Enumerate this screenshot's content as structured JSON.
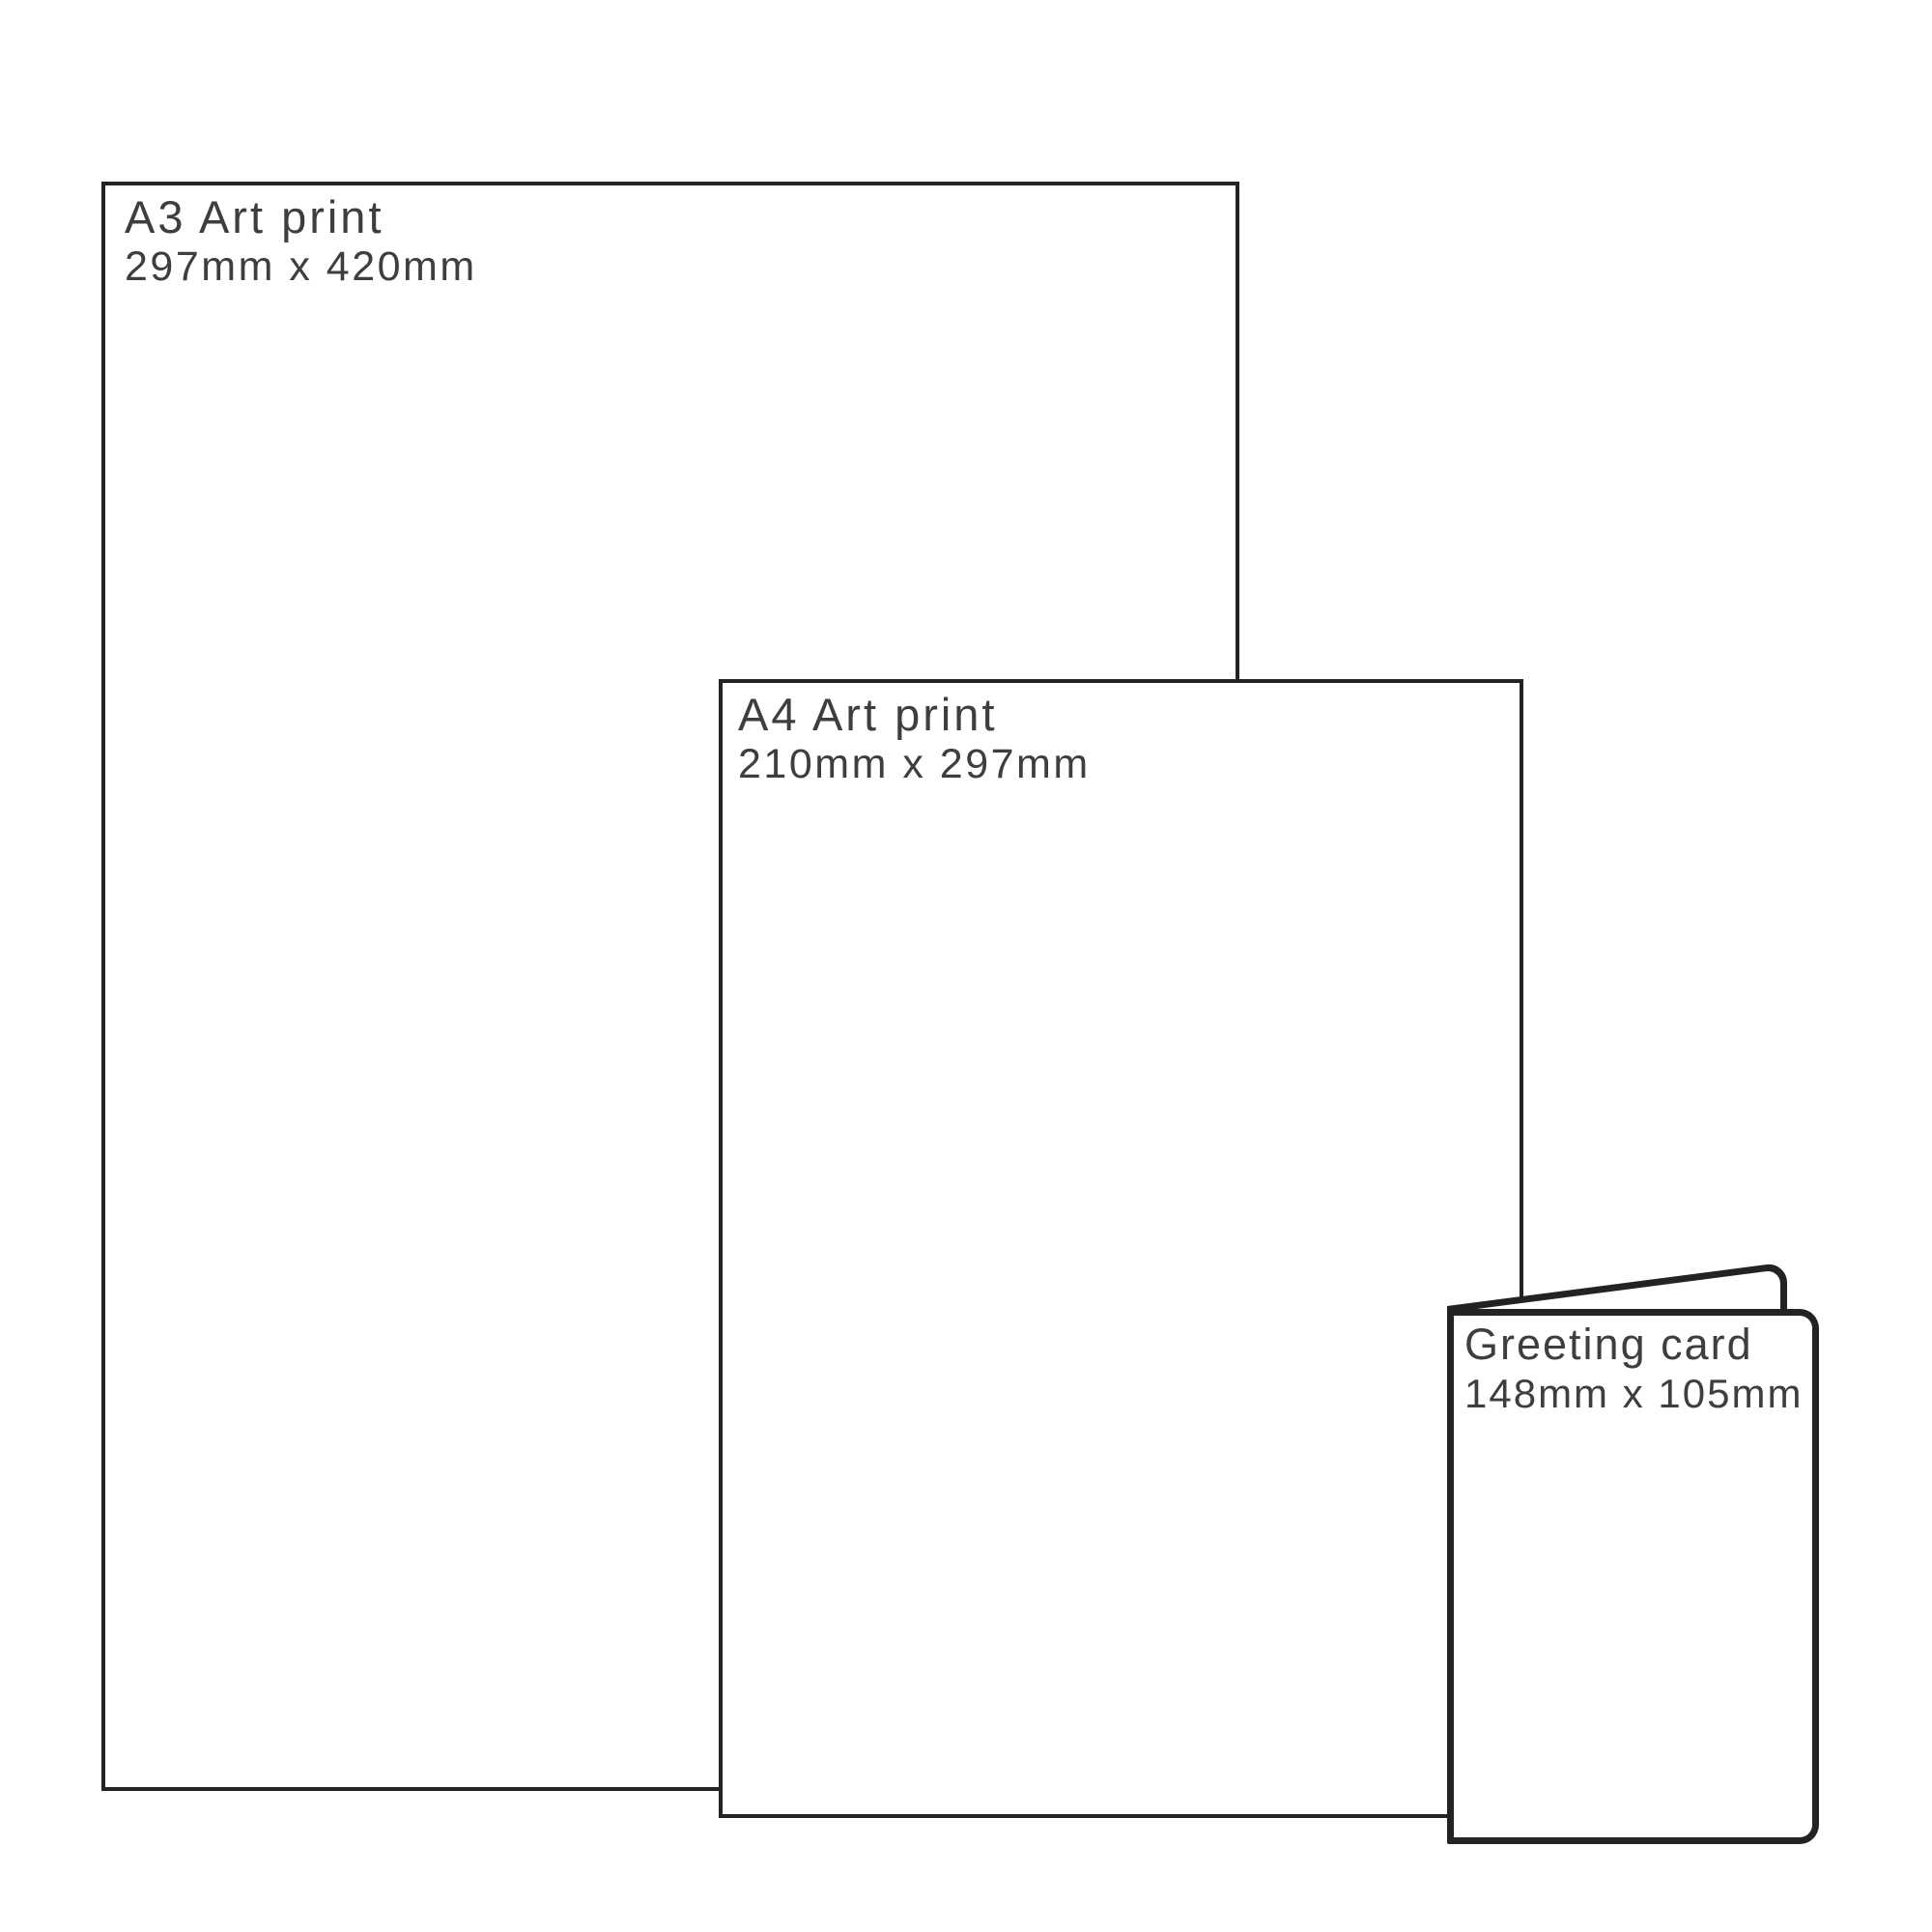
{
  "diagram": {
    "description": "Print product size comparison",
    "background_color": "#ffffff",
    "line_color": "#232323",
    "text_color": "#3e3e3e",
    "items": [
      {
        "title": "A3 Art print",
        "dimensions": "297mm x 420mm"
      },
      {
        "title": "A4 Art print",
        "dimensions": "210mm x 297mm"
      },
      {
        "title": "Greeting card",
        "dimensions": "148mm x 105mm"
      }
    ]
  }
}
